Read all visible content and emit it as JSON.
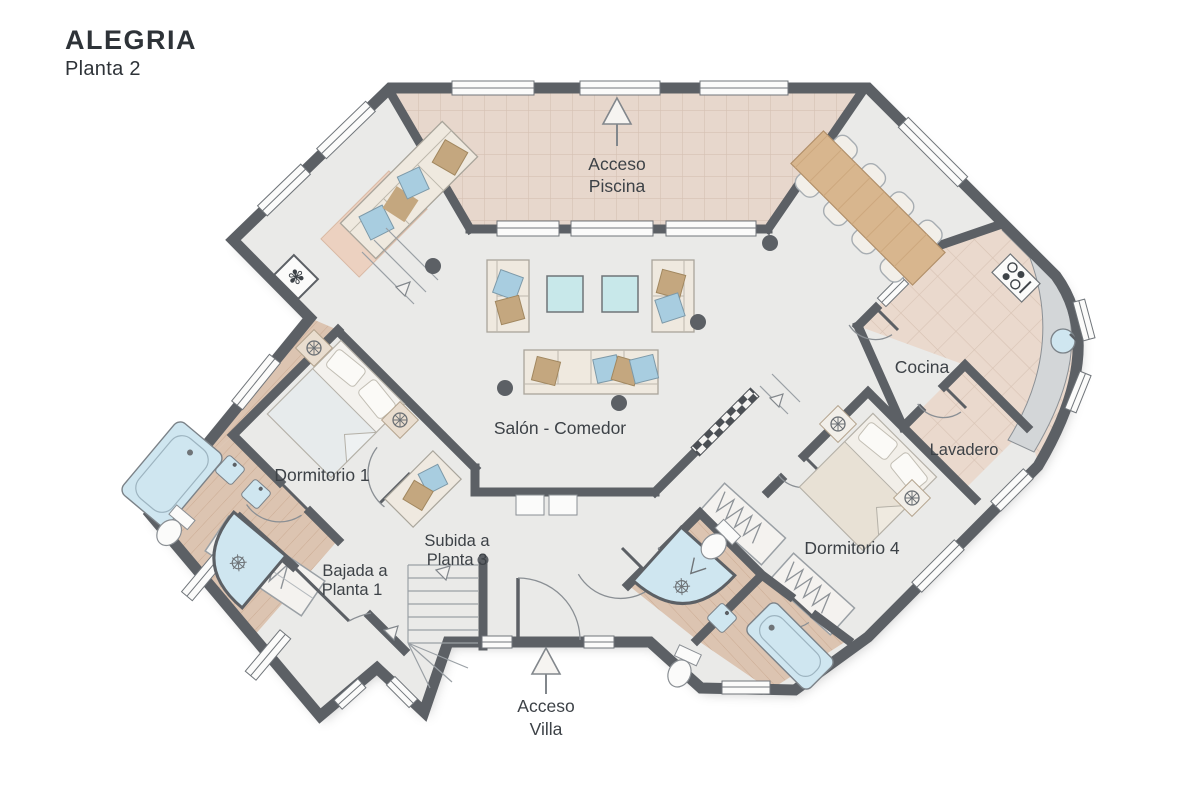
{
  "title": "ALEGRIA",
  "subtitle": "Planta 2",
  "rooms": {
    "pool_access": {
      "line1": "Acceso",
      "line2": "Piscina"
    },
    "living_dining": {
      "label": "Salón - Comedor"
    },
    "kitchen": {
      "label": "Cocina"
    },
    "laundry": {
      "label": "Lavadero"
    },
    "bedroom1": {
      "label": "Dormitorio 1"
    },
    "bedroom4": {
      "label": "Dormitorio 4"
    },
    "stairs_up": {
      "line1": "Subida a",
      "line2": "Planta 3"
    },
    "stairs_down": {
      "line1": "Bajada a",
      "line2": "Planta 1"
    },
    "villa_access": {
      "line1": "Acceso",
      "line2": "Villa"
    }
  },
  "icons": {
    "up_arrow": "direction-arrow",
    "lamp": "bedside-lamp",
    "plant": "plant",
    "shower_drain": "shower-drain"
  },
  "colors": {
    "wall": "#5c6065",
    "floor": "#eaeae8",
    "terrace_tile": "#e7d7cc",
    "kitchen_tile": "#ead9cd",
    "wood_floor": "#dcc4b1",
    "water_blue": "#cfe6f0",
    "table_blue": "#c8e8ea",
    "wood_furniture": "#d8b68e",
    "pillow_blue": "#a8cde0",
    "pillow_tan": "#c4a77f",
    "label_text": "#3d4247"
  }
}
